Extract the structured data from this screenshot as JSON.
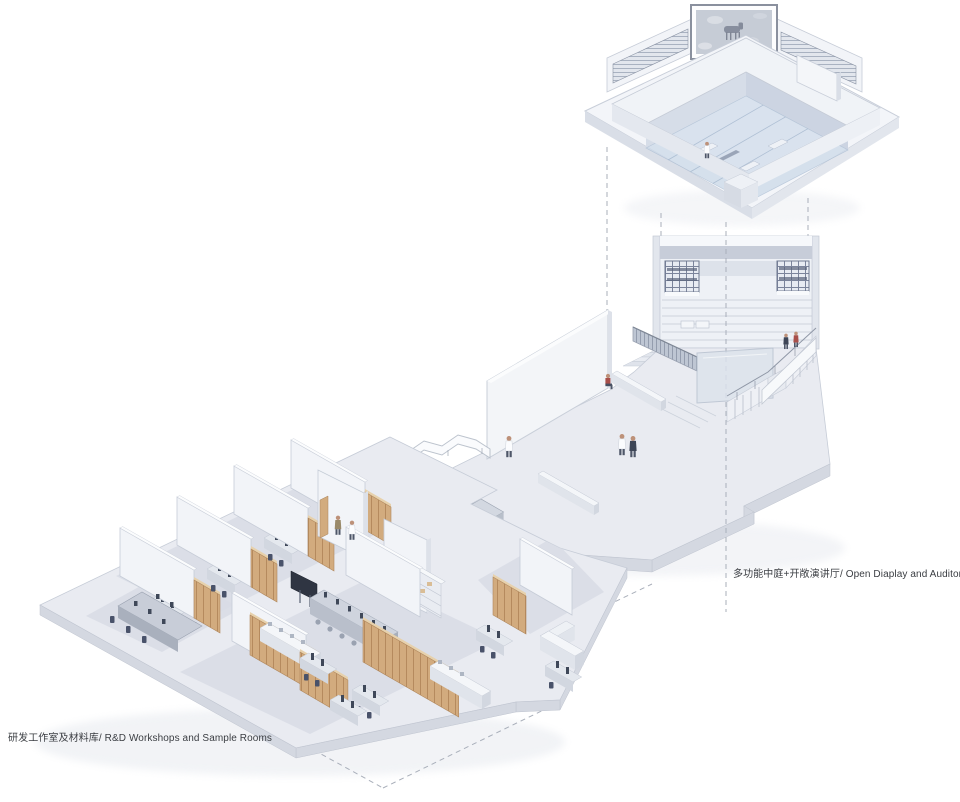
{
  "annotations": {
    "auditorium": "多功能中庭+开敞演讲厅/ Open Diaplay and Auditorium",
    "workshops": "研发工作室及材料库/ R&D Workshops and Sample Rooms"
  },
  "artwork": {
    "description": "framed grayscale artwork of grazing animals"
  },
  "colors": {
    "ink": "#3a3d42",
    "wall-face": "#f2f4f8",
    "wall-top": "#fbfcfd",
    "wall-side": "#dde1e9",
    "floor-top": "#e9ebf1",
    "floor-side": "#d4d8e1",
    "room-floor": "#d8dce5",
    "line": "#c6ccd7",
    "glass": "#ccd9e8",
    "wood": "#d2ab7e",
    "wood-dark": "#b0875c",
    "wood-light": "#e7d1ac",
    "furniture-dark": "#3f4859",
    "banner": "#c7cdd9",
    "grate": "#6f7990",
    "dash": "#a9afba",
    "accent-red": "#a84f4a"
  }
}
